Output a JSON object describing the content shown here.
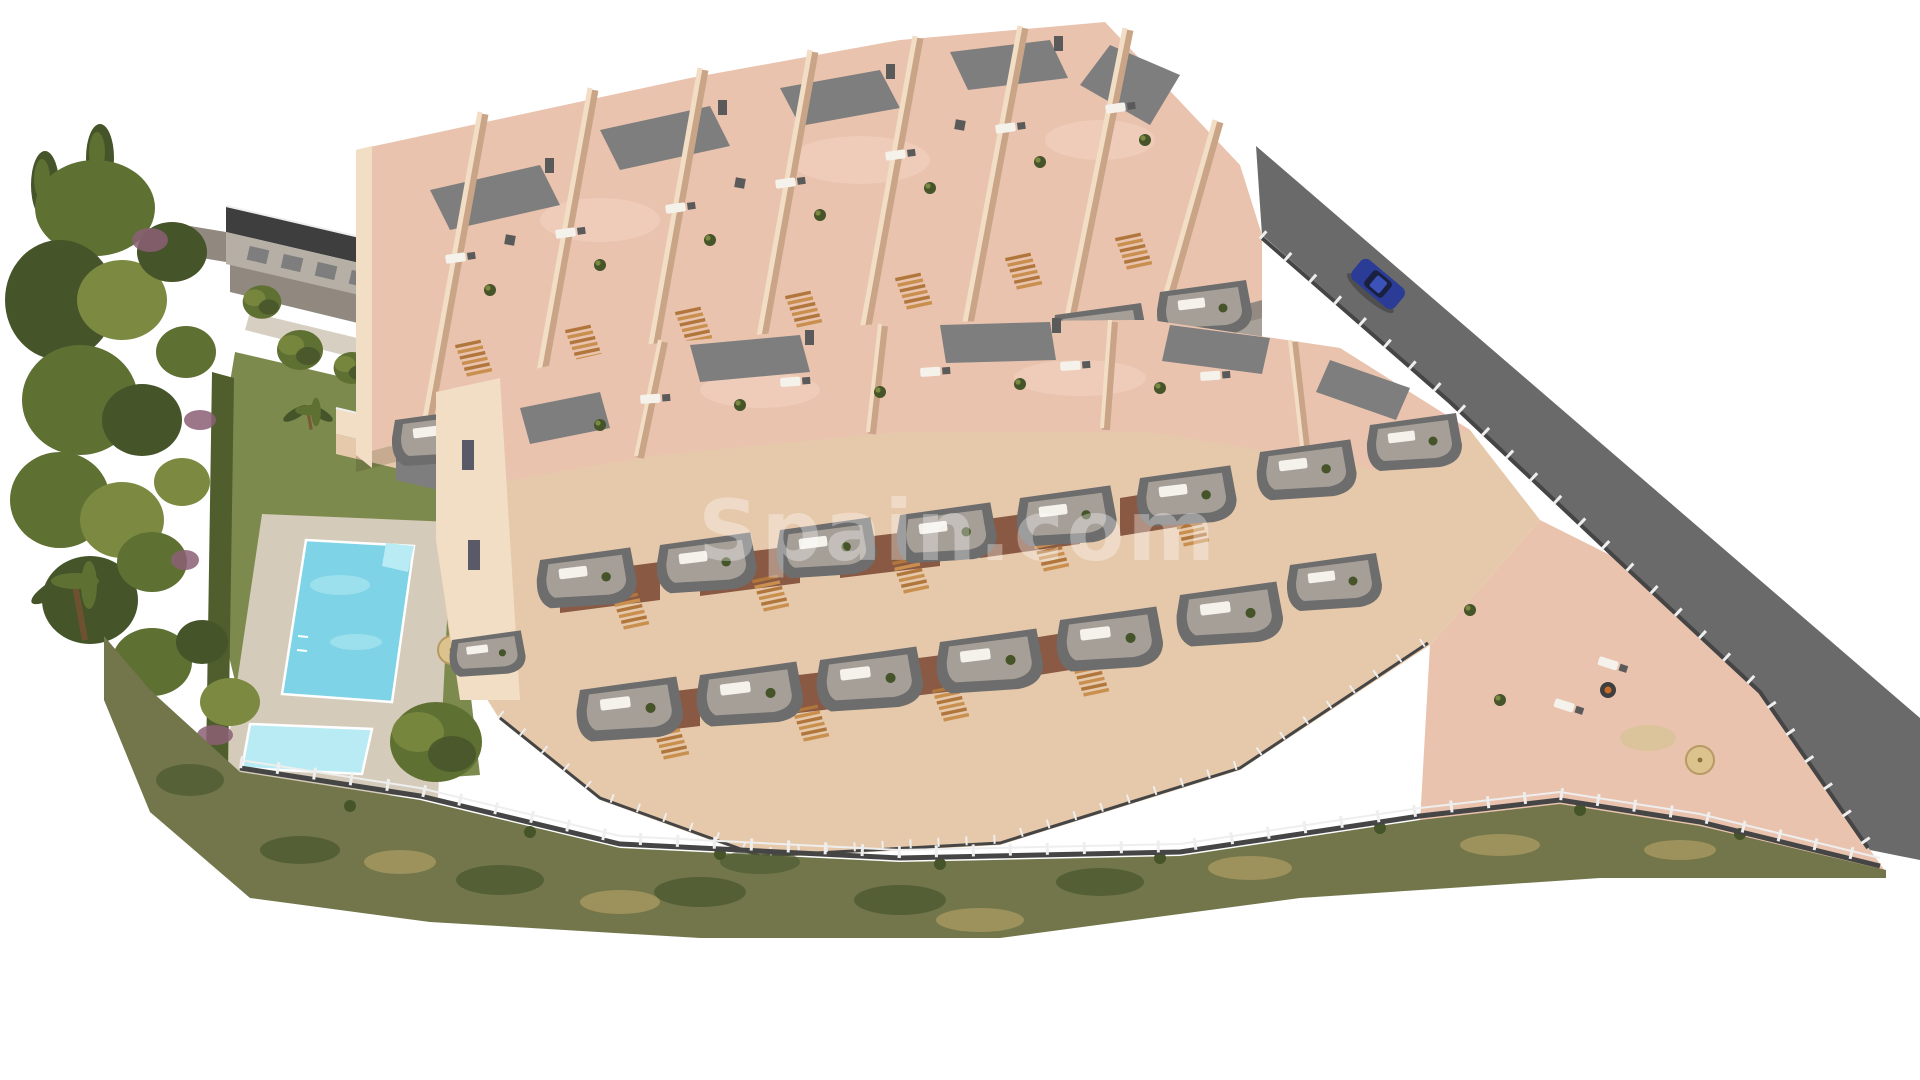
{
  "scene": {
    "kind": "aerial-architectural-render",
    "watermark": {
      "text": "Spain.com",
      "opacity": 0.33
    },
    "features": [
      "apartment-row-upper",
      "apartment-row-lower",
      "communal-pool",
      "kids-pool",
      "padel-court",
      "playground",
      "garden-lawn",
      "perimeter-road",
      "parked-car",
      "boundary-fence",
      "scrubland-slope",
      "tree-band",
      "pool-house",
      "garage-block",
      "corner-patio"
    ]
  },
  "colors": {
    "bg": "#ffffff",
    "paving": "#a7a199",
    "pavingDark": "#91897f",
    "pathLight": "#d6cfc2",
    "road": "#6a6a6a",
    "roofDark": "#3e3e3e",
    "roofGray": "#7e7e7e",
    "wall": "#e6c9ab",
    "wallLight": "#f2ddc5",
    "wallShadow": "#c9a486",
    "terrace": "#e9c3ae",
    "terraceLight": "#f3d6c3",
    "balcony": "#6d6d6d",
    "balcInner": "#a69f97",
    "wood": "#b1763c",
    "woodLight": "#c98f4e",
    "lawn": "#7c8a4e",
    "court": "#6d7c3b",
    "courtLine": "#9aa766",
    "tree": "#5f7033",
    "treeDark": "#46542a",
    "treeLight": "#7b8a40",
    "purple": "#8b5f74",
    "hedge": "#4f5e2c",
    "scrub": "#72764a",
    "scrubDark": "#4b5830",
    "scrubTan": "#a5975f",
    "water": "#7ed3e6",
    "waterLight": "#b9ebf4",
    "deck": "#d5cbba",
    "sand": "#d9b464",
    "fenceWhite": "#eeeeee",
    "fenceDark": "#454545",
    "glass": "#bed4dc",
    "car": "#2b3c96",
    "carGlass": "#1a2140",
    "brick": "#7a4632",
    "sofa": "#f5f2ec",
    "furnGray": "#5a5a5a",
    "watermark": "#ffffff"
  }
}
